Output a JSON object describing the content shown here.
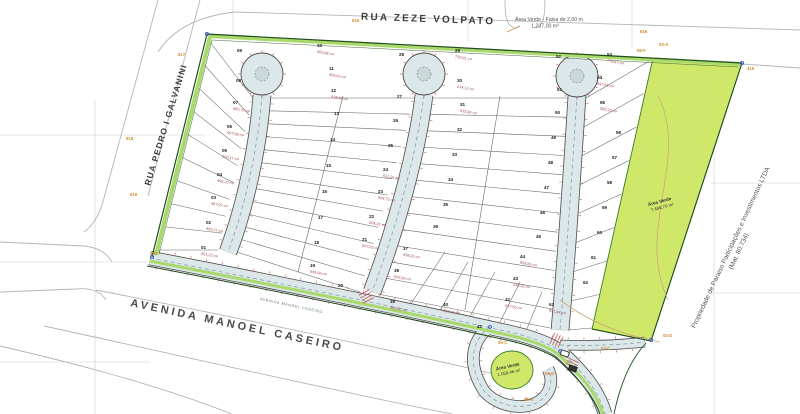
{
  "streets": {
    "top": "RUA ZEZE VOLPATO",
    "left": "RUA PEDRO I GALVANINI",
    "bottom": "AVENIDA MANOEL CASEIRO",
    "bottom_inner": "AVENIDA MANOEL CASEIRO"
  },
  "green_areas": {
    "strip_line1": "Área Verde - Faixa de 2,00 m",
    "strip_line2": "1.237,00 m²",
    "right_line1": "Área Verde",
    "right_line2": "7.486,76 m²",
    "blob_line1": "Área Verde",
    "blob_line2": "1.058,46 m²"
  },
  "property": {
    "line1": "Propriedade de Paraiso Participações e Investimentos LTDA",
    "line2": "(Mat. 80.734)"
  },
  "colors": {
    "green_area": "#cfe86a",
    "street_fill": "#dbe7e8",
    "boundary_green": "#2e6b2e",
    "strip_green": "#a8d96a",
    "red_detail": "#c05555",
    "area_text": "#9c4a4a",
    "point_label": "#d2882c"
  },
  "survey_points": [
    {
      "label": "616",
      "x": 640,
      "y": 33
    },
    {
      "label": "616",
      "x": 352,
      "y": 22
    },
    {
      "label": "416",
      "x": 747,
      "y": 70
    },
    {
      "label": "617",
      "x": 178,
      "y": 56
    },
    {
      "label": "618",
      "x": 126,
      "y": 140
    },
    {
      "label": "619",
      "x": 130,
      "y": 196
    },
    {
      "label": "620",
      "x": 150,
      "y": 255
    },
    {
      "label": "03-A",
      "x": 659,
      "y": 46
    },
    {
      "label": "05-F",
      "x": 637,
      "y": 52
    },
    {
      "label": "03-C",
      "x": 601,
      "y": 350
    },
    {
      "label": "03-D",
      "x": 663,
      "y": 337
    },
    {
      "label": "06-A",
      "x": 524,
      "y": 401
    },
    {
      "label": "06-C",
      "x": 498,
      "y": 344
    },
    {
      "label": "06-D",
      "x": 545,
      "y": 375
    }
  ],
  "lots": [
    {
      "n": "01",
      "x": 201,
      "y": 249,
      "area": "561,23 m²"
    },
    {
      "n": "02",
      "x": 206,
      "y": 224,
      "area": "465,27 m²"
    },
    {
      "n": "03",
      "x": 211,
      "y": 199,
      "area": "487,97 m²"
    },
    {
      "n": "04",
      "x": 217,
      "y": 176,
      "area": "495,20 m²"
    },
    {
      "n": "05",
      "x": 222,
      "y": 152,
      "area": "500,17 m²"
    },
    {
      "n": "06",
      "x": 227,
      "y": 128,
      "area": "497,58 m²"
    },
    {
      "n": "07",
      "x": 233,
      "y": 104,
      "area": "480,72 m²"
    },
    {
      "n": "08",
      "x": 236,
      "y": 82,
      "area": ""
    },
    {
      "n": "09",
      "x": 237,
      "y": 52,
      "area": ""
    },
    {
      "n": "10",
      "x": 317,
      "y": 47,
      "area": "503,98 m²"
    },
    {
      "n": "11",
      "x": 329,
      "y": 70,
      "area": "503,63 m²"
    },
    {
      "n": "12",
      "x": 331,
      "y": 92,
      "area": "618,42 m²"
    },
    {
      "n": "13",
      "x": 334,
      "y": 115,
      "area": ""
    },
    {
      "n": "14",
      "x": 330,
      "y": 141,
      "area": ""
    },
    {
      "n": "15",
      "x": 326,
      "y": 167,
      "area": ""
    },
    {
      "n": "16",
      "x": 322,
      "y": 193,
      "area": ""
    },
    {
      "n": "17",
      "x": 318,
      "y": 219,
      "area": ""
    },
    {
      "n": "18",
      "x": 314,
      "y": 244,
      "area": ""
    },
    {
      "n": "19",
      "x": 310,
      "y": 267,
      "area": "545,06 m²"
    },
    {
      "n": "20",
      "x": 338,
      "y": 287,
      "area": ""
    },
    {
      "n": "21",
      "x": 362,
      "y": 241,
      "area": "607,03 m²"
    },
    {
      "n": "22",
      "x": 369,
      "y": 218,
      "area": "608,32 m²"
    },
    {
      "n": "23",
      "x": 378,
      "y": 193,
      "area": "568,73 m²"
    },
    {
      "n": "24",
      "x": 383,
      "y": 171,
      "area": "611,26 m²"
    },
    {
      "n": "25",
      "x": 388,
      "y": 147,
      "area": ""
    },
    {
      "n": "26",
      "x": 393,
      "y": 122,
      "area": ""
    },
    {
      "n": "27",
      "x": 397,
      "y": 98,
      "area": ""
    },
    {
      "n": "28",
      "x": 399,
      "y": 56,
      "area": ""
    },
    {
      "n": "29",
      "x": 455,
      "y": 52,
      "area": "732,91 m²"
    },
    {
      "n": "30",
      "x": 457,
      "y": 82,
      "area": "614,12 m²"
    },
    {
      "n": "31",
      "x": 460,
      "y": 106,
      "area": "615,96 m²"
    },
    {
      "n": "32",
      "x": 457,
      "y": 131,
      "area": ""
    },
    {
      "n": "33",
      "x": 452,
      "y": 156,
      "area": ""
    },
    {
      "n": "34",
      "x": 448,
      "y": 181,
      "area": ""
    },
    {
      "n": "35",
      "x": 443,
      "y": 206,
      "area": ""
    },
    {
      "n": "36",
      "x": 433,
      "y": 228,
      "area": ""
    },
    {
      "n": "37",
      "x": 403,
      "y": 250,
      "area": "608,26 m²"
    },
    {
      "n": "38",
      "x": 394,
      "y": 272,
      "area": "602,93 m²"
    },
    {
      "n": "39",
      "x": 390,
      "y": 303,
      "area": "480,00 m²"
    },
    {
      "n": "40",
      "x": 443,
      "y": 306,
      "area": "950,00 m²"
    },
    {
      "n": "41",
      "x": 477,
      "y": 328,
      "area": ""
    },
    {
      "n": "42",
      "x": 505,
      "y": 301,
      "area": "637,50 m²"
    },
    {
      "n": "43",
      "x": 513,
      "y": 280,
      "area": "638,26 m²"
    },
    {
      "n": "44",
      "x": 520,
      "y": 258,
      "area": "958,86 m²"
    },
    {
      "n": "45",
      "x": 536,
      "y": 238,
      "area": ""
    },
    {
      "n": "46",
      "x": 540,
      "y": 214,
      "area": ""
    },
    {
      "n": "47",
      "x": 544,
      "y": 189,
      "area": ""
    },
    {
      "n": "48",
      "x": 548,
      "y": 164,
      "area": ""
    },
    {
      "n": "49",
      "x": 551,
      "y": 139,
      "area": ""
    },
    {
      "n": "50",
      "x": 555,
      "y": 114,
      "area": ""
    },
    {
      "n": "51",
      "x": 557,
      "y": 91,
      "area": ""
    },
    {
      "n": "52",
      "x": 556,
      "y": 58,
      "area": ""
    },
    {
      "n": "53",
      "x": 607,
      "y": 56,
      "area": "779,47 m²"
    },
    {
      "n": "54",
      "x": 597,
      "y": 79,
      "area": "697,69 m²"
    },
    {
      "n": "55",
      "x": 600,
      "y": 104,
      "area": "583,33 m²"
    },
    {
      "n": "56",
      "x": 616,
      "y": 134,
      "area": ""
    },
    {
      "n": "57",
      "x": 612,
      "y": 159,
      "area": ""
    },
    {
      "n": "58",
      "x": 607,
      "y": 184,
      "area": ""
    },
    {
      "n": "59",
      "x": 602,
      "y": 209,
      "area": ""
    },
    {
      "n": "60",
      "x": 597,
      "y": 234,
      "area": ""
    },
    {
      "n": "61",
      "x": 591,
      "y": 259,
      "area": ""
    },
    {
      "n": "62",
      "x": 583,
      "y": 284,
      "area": ""
    },
    {
      "n": "63",
      "x": 549,
      "y": 306,
      "area": "621,44 m²"
    }
  ]
}
